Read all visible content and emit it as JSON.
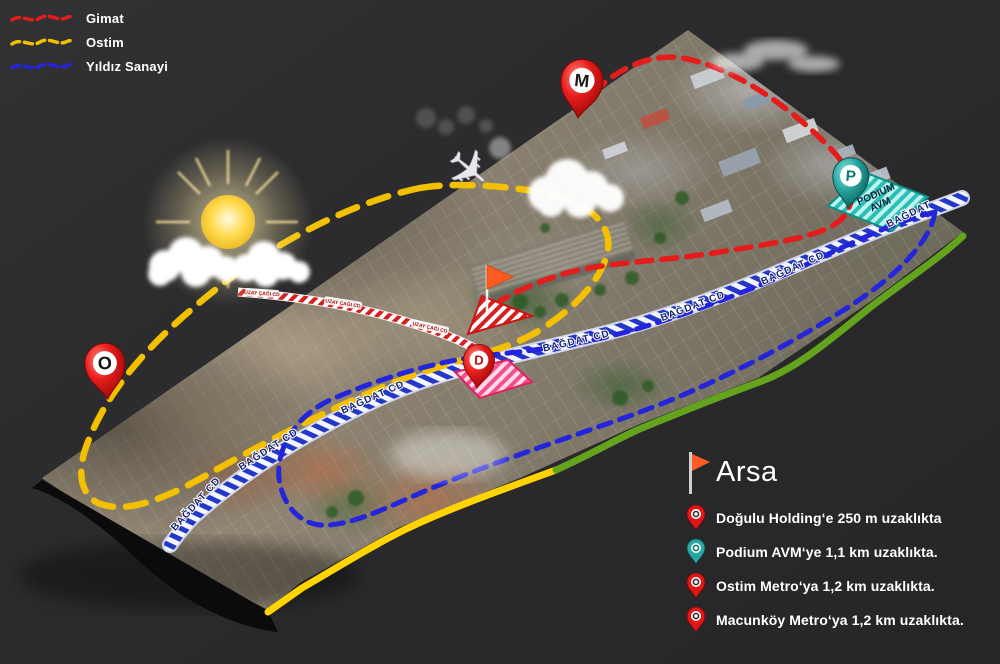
{
  "legend_routes": {
    "items": [
      {
        "label": "Gimat",
        "color": "#e51c1c"
      },
      {
        "label": "Ostim",
        "color": "#f3c000"
      },
      {
        "label": "Yıldız Sanayi",
        "color": "#2424dd"
      }
    ]
  },
  "map": {
    "road_label": "BAĞDAT CD",
    "road_label_short": "BAĞDAT",
    "side_road_label": "UZAY ÇAĞI CD",
    "podium_area": {
      "line1": "PODIUM",
      "line2": "AVM"
    },
    "pins": {
      "macunkoy_metro_letter": "M",
      "ostim_metro_letter": "O",
      "dogulu_letter": "D",
      "podium_letter": "P"
    },
    "pin_colors": {
      "red": "#e01717",
      "teal": "#2aa7a2"
    }
  },
  "legend_site": {
    "title": "Arsa",
    "items": [
      {
        "icon": "red-pin",
        "text": "Doğulu Holding‘e 250 m uzaklıkta"
      },
      {
        "icon": "teal-pin",
        "text": "Podium AVM‘ye 1,1 km uzaklıkta."
      },
      {
        "icon": "red-pin",
        "text": "Ostim Metro‘ya 1,2 km uzaklıkta."
      },
      {
        "icon": "red-pin",
        "text": "Macunköy Metro‘ya 1,2 km  uzaklıkta."
      }
    ]
  }
}
